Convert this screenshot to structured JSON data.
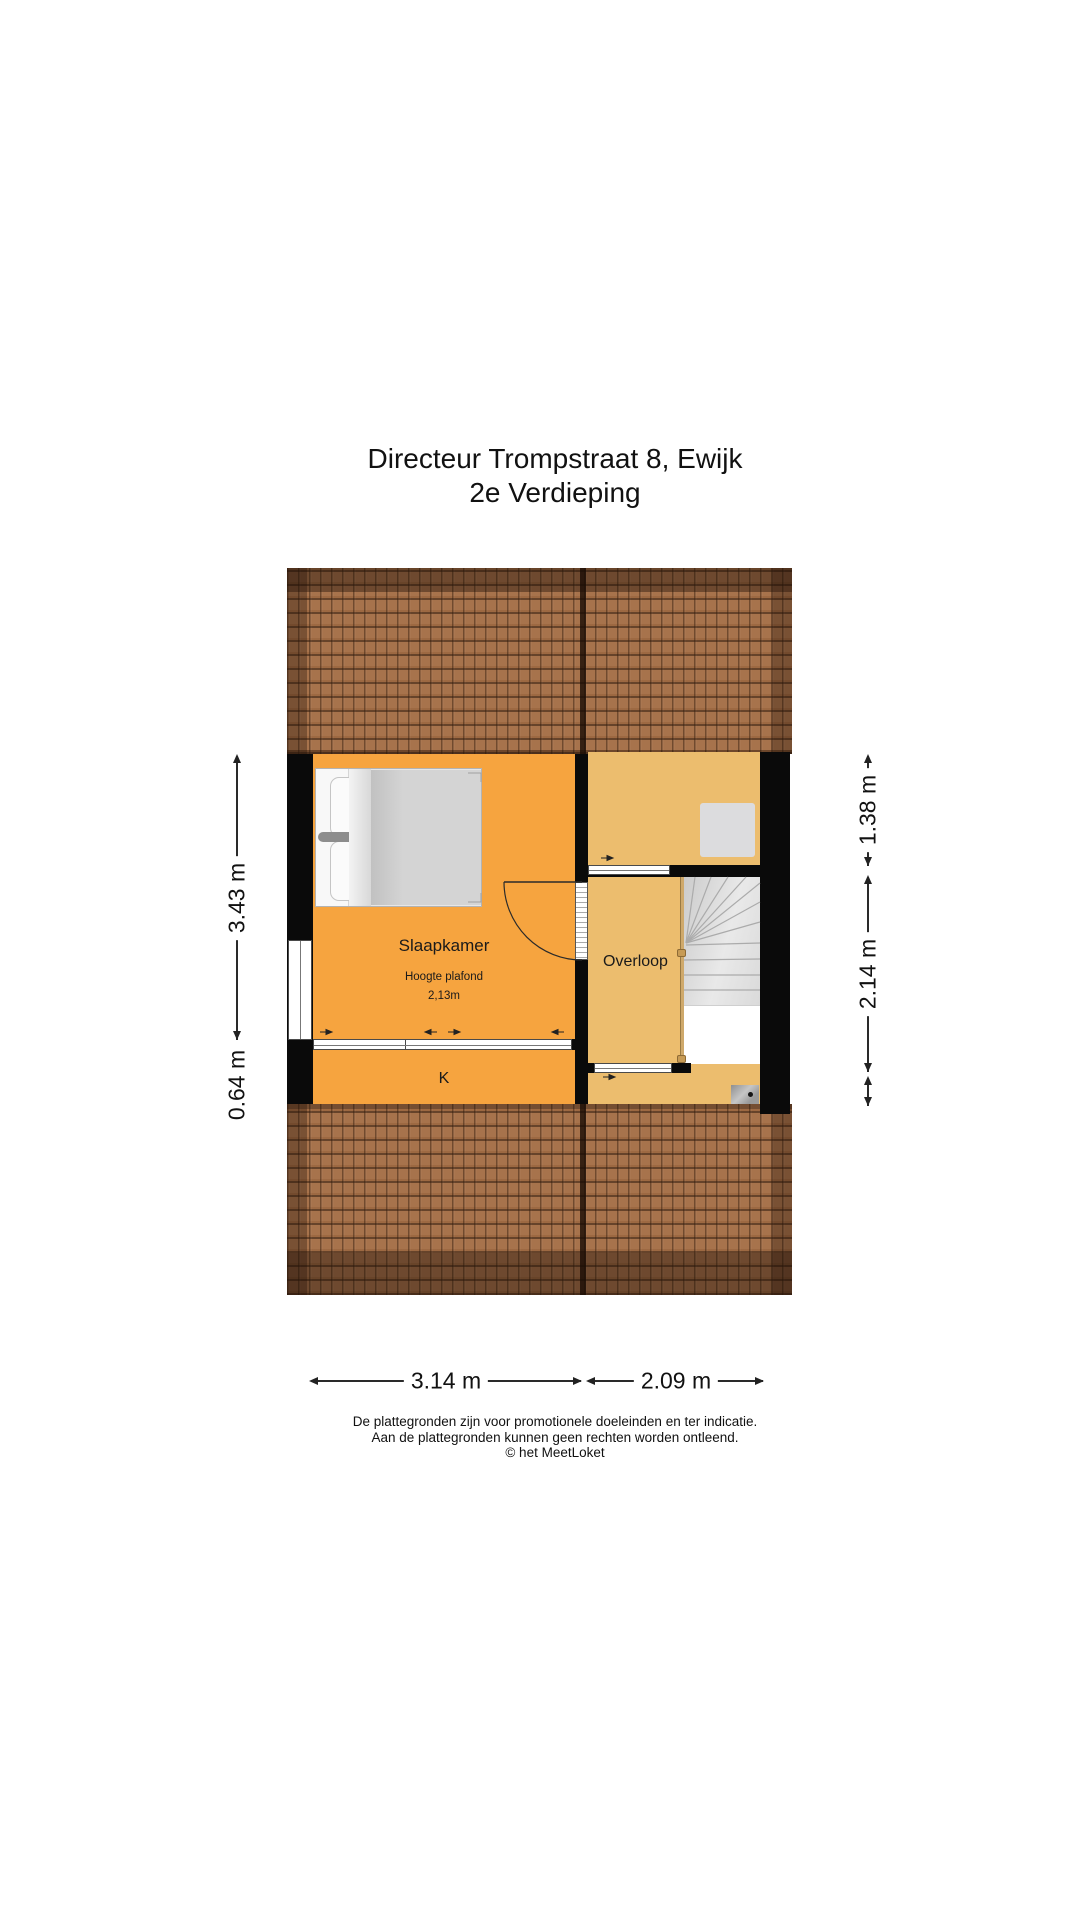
{
  "title": {
    "line1": "Directeur Trompstraat 8, Ewijk",
    "line2": "2e Verdieping"
  },
  "rooms": {
    "slaapkamer": {
      "label": "Slaapkamer",
      "ceiling_note_line1": "Hoogte plafond",
      "ceiling_note_line2": "2,13m"
    },
    "overloop": {
      "label": "Overloop"
    },
    "closet": {
      "label": "K"
    }
  },
  "dimensions": {
    "left_vertical": [
      {
        "label": "3.43 m"
      },
      {
        "label": "0.64 m"
      }
    ],
    "right_vertical": [
      {
        "label": "1.38 m"
      },
      {
        "label": "2.14 m"
      }
    ],
    "bottom_horizontal": [
      {
        "label": "3.14 m"
      },
      {
        "label": "2.09 m"
      }
    ]
  },
  "footer": {
    "line1": "De plattegronden zijn voor promotionele doeleinden en ter indicatie.",
    "line2": "Aan de plattegronden kunnen geen rechten worden ontleend.",
    "line3": "© het MeetLoket"
  },
  "icons": {
    "bed": "double-bed",
    "staircase": "winder-staircase",
    "skylight": "roof-window",
    "boiler": "boiler-unit",
    "door": "door-swing"
  },
  "colors": {
    "floor_orange": "#f6a43f",
    "floor_tan": "#ecbd6e",
    "roof_brown": "#a7734c",
    "wall_black": "#0a0a0a",
    "stair_gray": "#dfdfdf"
  }
}
